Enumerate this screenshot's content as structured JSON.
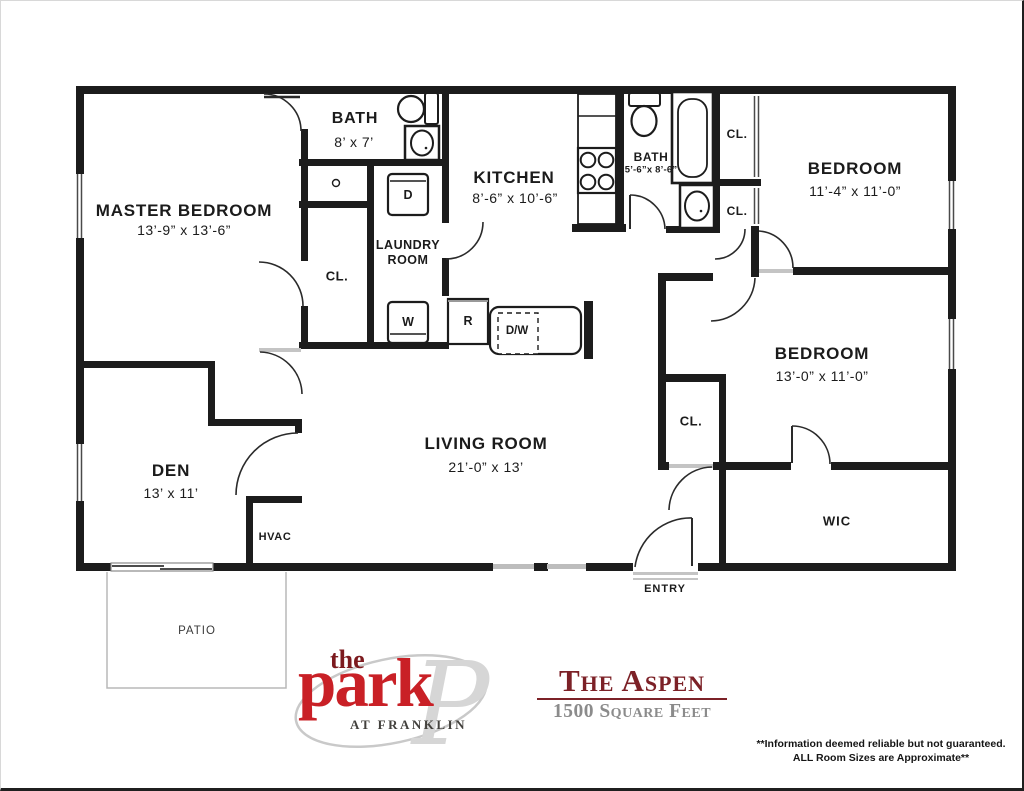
{
  "rooms": {
    "master_bedroom": {
      "name": "MASTER BEDROOM",
      "dims": "13’-9” x 13’-6”"
    },
    "bath_master": {
      "name": "BATH",
      "dims": "8’ x 7’"
    },
    "kitchen": {
      "name": "KITCHEN",
      "dims": "8’-6” x 10’-6”"
    },
    "laundry": {
      "name": "LAUNDRY ROOM"
    },
    "bath_hall": {
      "name": "BATH",
      "dims": "5’-6”x 8’-6”"
    },
    "bedroom_1": {
      "name": "BEDROOM",
      "dims": "11’-4” x 11’-0”"
    },
    "bedroom_2": {
      "name": "BEDROOM",
      "dims": "13’-0” x 11’-0”"
    },
    "living_room": {
      "name": "LIVING ROOM",
      "dims": "21’-0” x 13’"
    },
    "den": {
      "name": "DEN",
      "dims": "13’ x 11’"
    },
    "wic": {
      "name": "WIC"
    },
    "hvac": {
      "name": "HVAC"
    },
    "entry": {
      "name": "ENTRY"
    },
    "patio": {
      "name": "PATIO"
    }
  },
  "closet_label": "CL.",
  "appliances": {
    "dryer": "D",
    "washer": "W",
    "refrigerator": "R",
    "dishwasher": "D/W"
  },
  "branding": {
    "logo_the": "the",
    "logo_park": "park",
    "logo_tagline": "AT FRANKLIN",
    "logo_monogram": "P",
    "plan_name": "The Aspen",
    "plan_size": "1500 Square Feet"
  },
  "disclaimer": {
    "line1": "**Information deemed reliable but not guaranteed.",
    "line2": "ALL Room Sizes are Approximate**"
  },
  "colors": {
    "wall": "#1c1c1c",
    "logo_red": "#c92026",
    "logo_dark_red": "#7c1a1e",
    "title_red": "#7c2127",
    "muted_gray": "#8b8b8b"
  }
}
